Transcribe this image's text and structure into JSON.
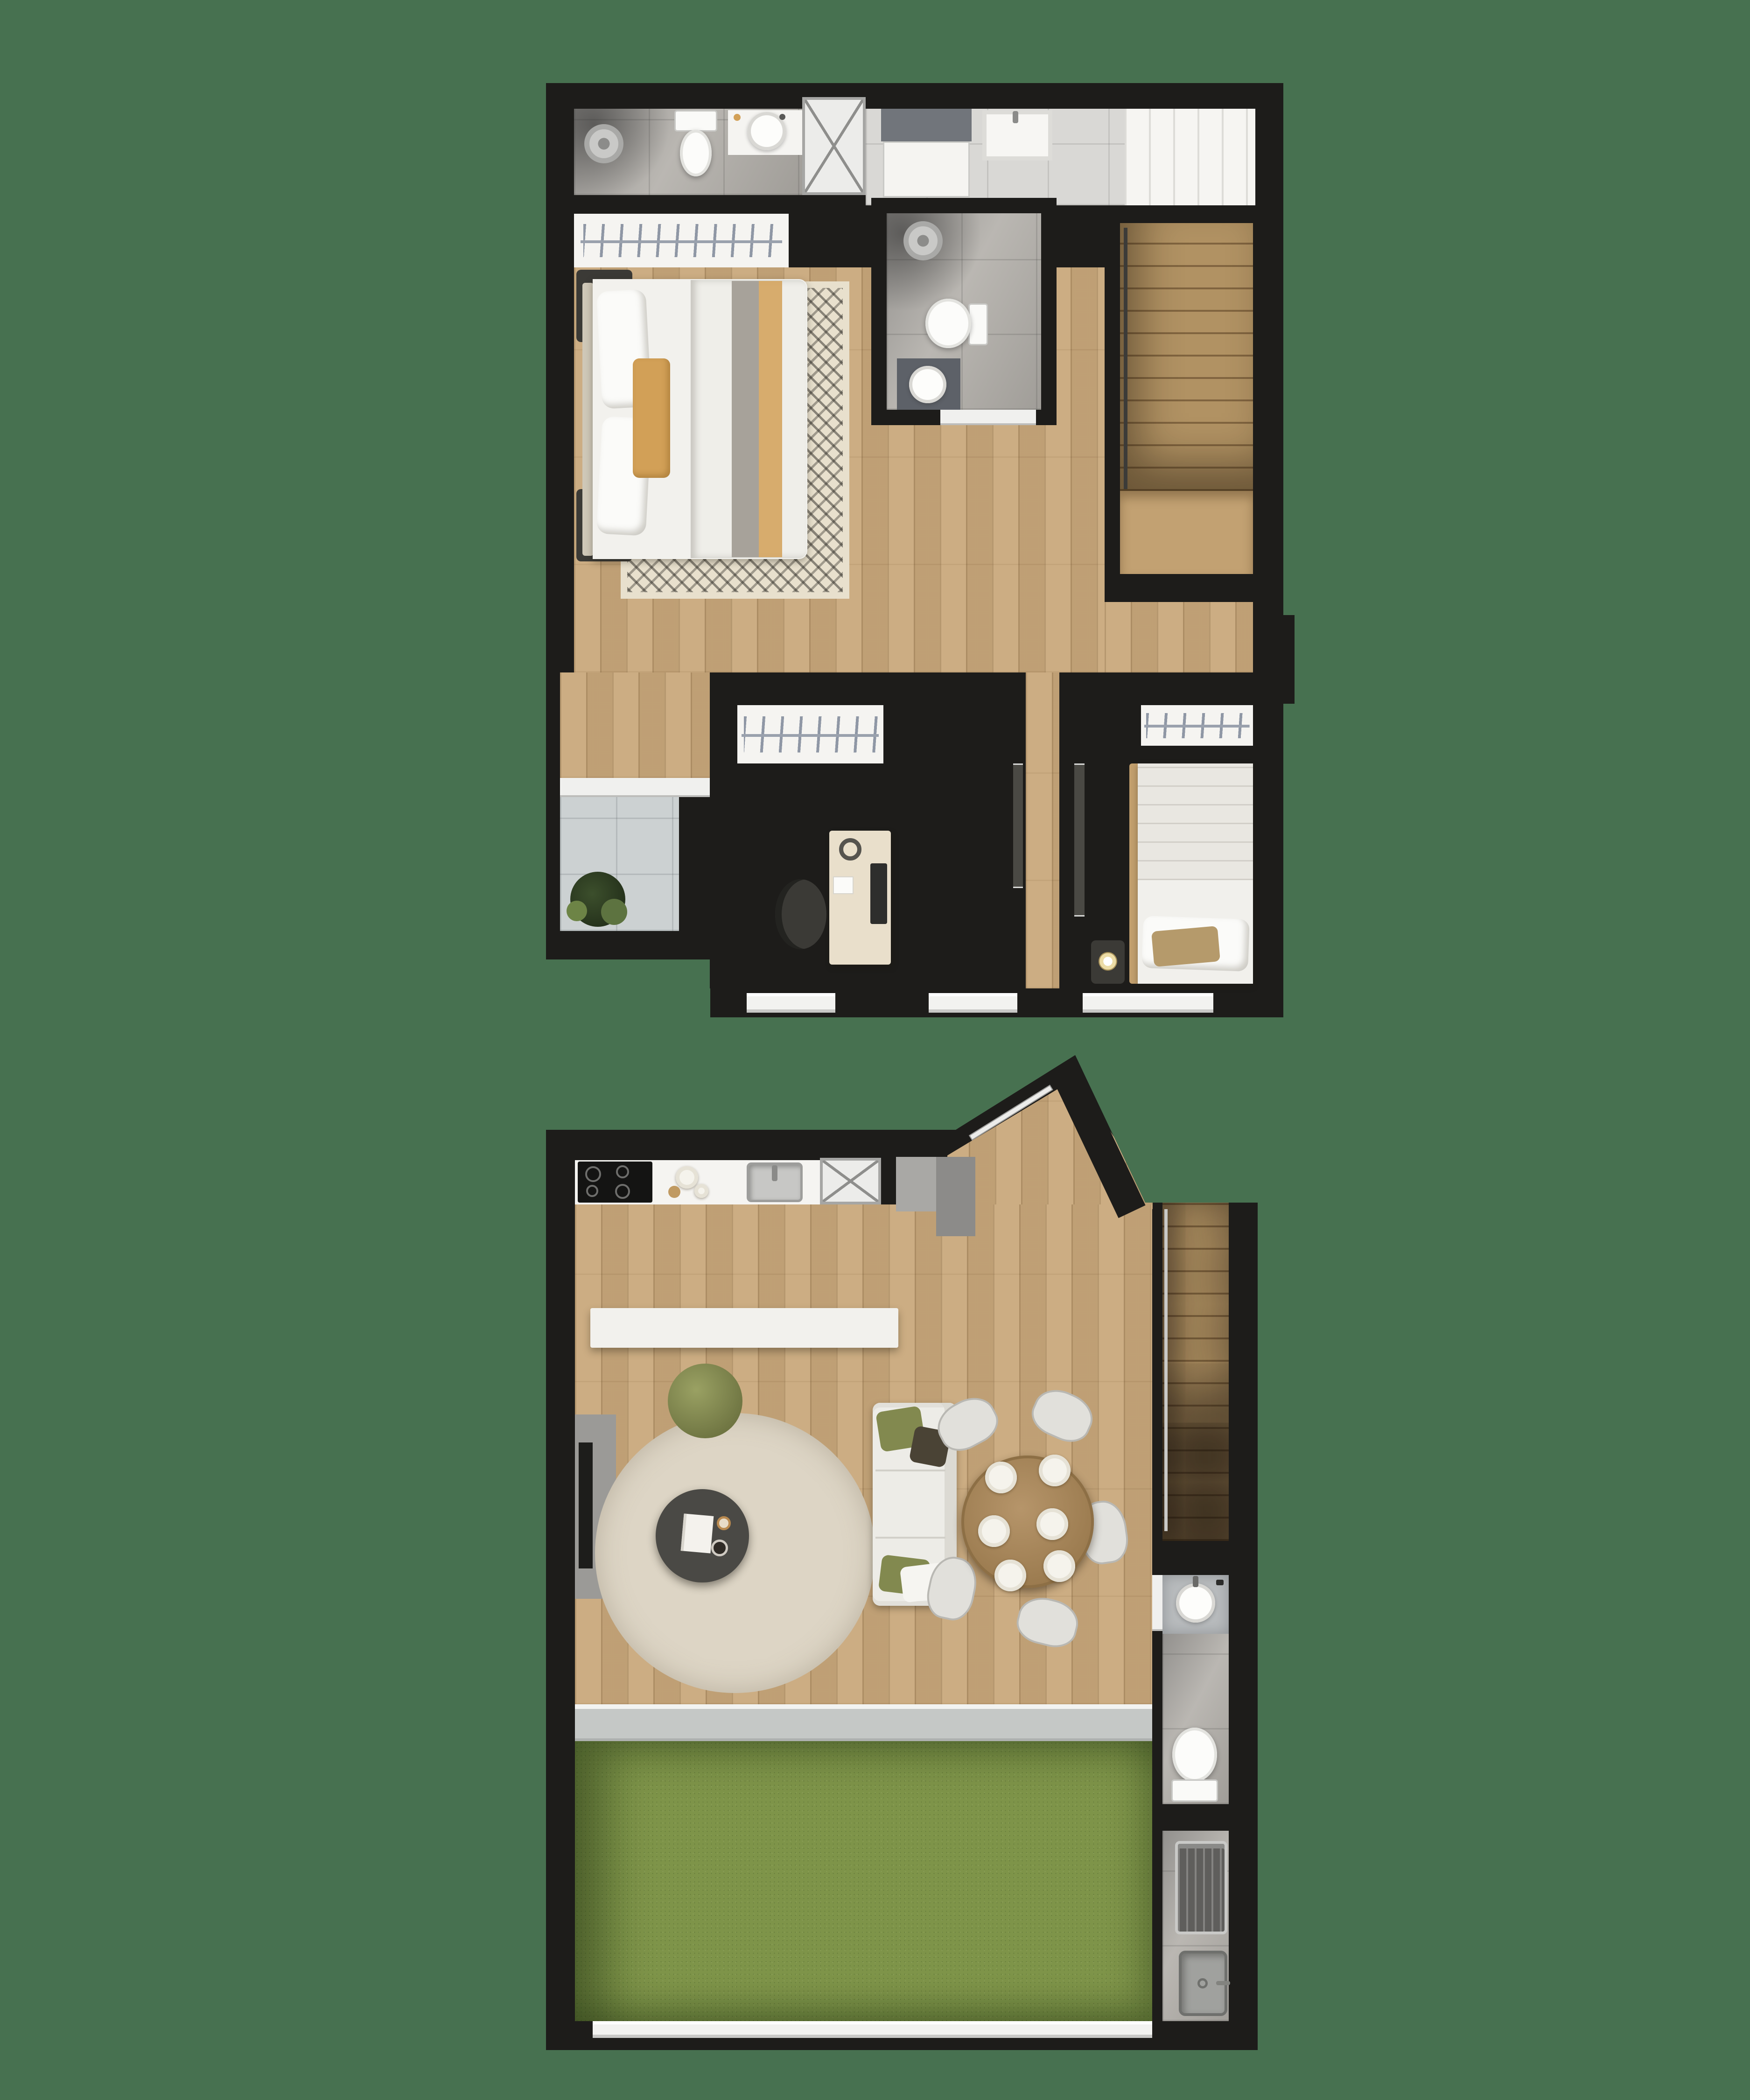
{
  "document": {
    "type": "architectural-floor-plan-render",
    "view": "top-down",
    "floors_shown": 2,
    "visible_text": ""
  },
  "colors": {
    "background": "#477150",
    "walls": "#1d1c1a",
    "wood_floor": "#c9a87b",
    "stair_wood": "#b19263",
    "tile_gray": "#a3a19d",
    "tile_light": "#d8d7d4",
    "terrace_tile": "#ccd1d2",
    "white_fixture": "#f5f4f1",
    "rug_beige": "#e8e0cd",
    "round_rug": "#ddd5c5",
    "grass": "#7e9449",
    "accent_tan": "#d2a057",
    "cushion_green": "#82894f",
    "dark_furniture": "#3b3a36",
    "counter_gray": "#9b9a97",
    "table_wood": "#a8875a"
  },
  "plans": [
    {
      "name": "upper-floor",
      "position": "top",
      "rooms": [
        {
          "name": "ensuite-bathroom",
          "furniture": [
            "shower-head",
            "toilet",
            "vanity-sink"
          ]
        },
        {
          "name": "laundry-utility",
          "furniture": [
            "shower-box",
            "appliance",
            "laundry-tub",
            "shelf-cabinet"
          ]
        },
        {
          "name": "master-bedroom",
          "furniture": [
            "wardrobe-hangers",
            "double-bed",
            "nightstand-lamp",
            "nightstand-lamp",
            "chevron-rug"
          ]
        },
        {
          "name": "hall-bathroom",
          "furniture": [
            "shower-head",
            "toilet",
            "vanity-sink"
          ]
        },
        {
          "name": "stairwell",
          "furniture": [
            "stairs",
            "handrail"
          ]
        },
        {
          "name": "office",
          "furniture": [
            "wardrobe-hangers",
            "desk",
            "monitor",
            "headphones",
            "office-chair"
          ]
        },
        {
          "name": "bedroom-2",
          "furniture": [
            "wardrobe-hangers",
            "single-bed",
            "nightstand-lamp"
          ]
        },
        {
          "name": "balcony-terrace",
          "furniture": [
            "plant",
            "sliding-door"
          ]
        }
      ]
    },
    {
      "name": "ground-floor",
      "position": "bottom",
      "rooms": [
        {
          "name": "kitchen",
          "furniture": [
            "cooktop",
            "counter",
            "plates",
            "steel-sink",
            "shower-box",
            "gray-cabinet",
            "island-counter"
          ]
        },
        {
          "name": "living-room",
          "furniture": [
            "tv-console",
            "round-rug",
            "pouf",
            "coffee-table",
            "sofa",
            "cushions"
          ]
        },
        {
          "name": "dining-area",
          "furniture": [
            "round-table",
            "plates",
            "chairs"
          ]
        },
        {
          "name": "entry",
          "furniture": [
            "angled-walls",
            "entry-door"
          ]
        },
        {
          "name": "stairwell",
          "furniture": [
            "stairs",
            "handrail"
          ]
        },
        {
          "name": "bathroom",
          "furniture": [
            "vanity-sink",
            "toilet"
          ]
        },
        {
          "name": "service-area",
          "furniture": [
            "washing-machine",
            "laundry-sink"
          ]
        },
        {
          "name": "backyard",
          "furniture": [
            "lawn",
            "glass-door-track"
          ]
        }
      ]
    }
  ]
}
